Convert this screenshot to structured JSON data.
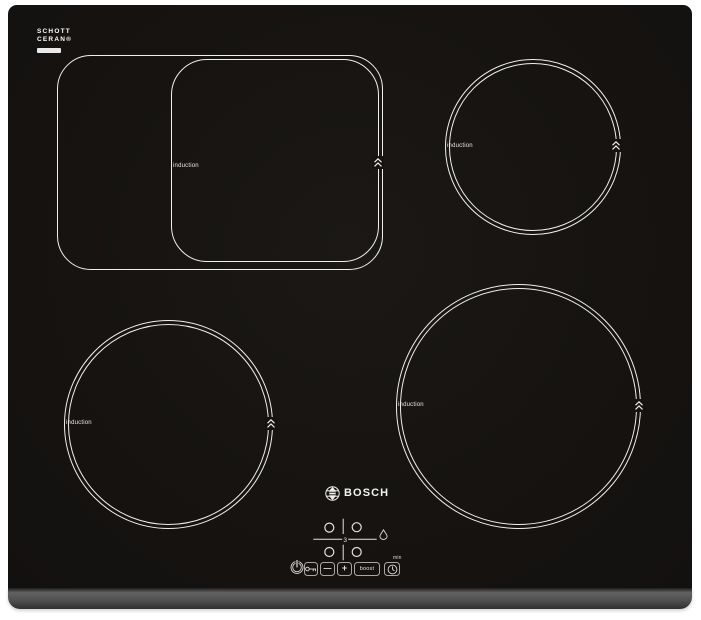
{
  "branding": {
    "glass_maker": {
      "line1": "SCHOTT",
      "line2": "CERAN®"
    },
    "brand": "BOSCH"
  },
  "zones": {
    "dual": {
      "label": "induction"
    },
    "top_right": {
      "label": "induction"
    },
    "bottom_left": {
      "label": "induction"
    },
    "bottom_right": {
      "label": "induction"
    }
  },
  "display": {
    "power_level": "3"
  },
  "controls": {
    "minus": "—",
    "plus": "+",
    "boost": "boost",
    "timer_unit": "min"
  },
  "icons": {
    "power": "power-icon",
    "child_lock": "key-icon",
    "timer": "clock-icon",
    "pan_protection": "droplet-icon",
    "boost_marker": "double-chevron-up-icon",
    "brand_emblem": "bosch-armature-icon"
  },
  "colors": {
    "background": "#ffffff",
    "glass": "#161310",
    "zone_ring": "#f0efec",
    "trim_light": "#5d5d5d",
    "trim_dark": "#2e2e2e"
  }
}
